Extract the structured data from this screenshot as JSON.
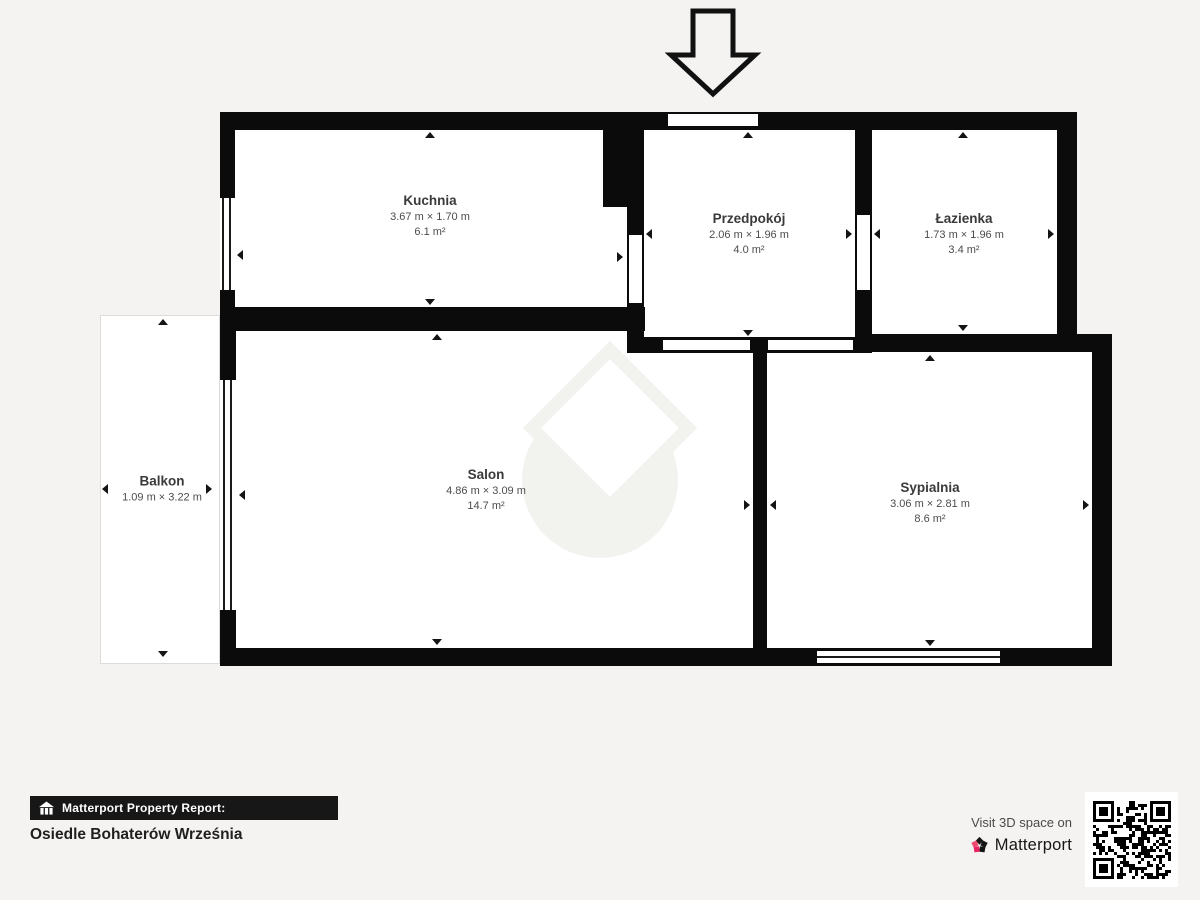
{
  "page": {
    "background": "#f4f3f1",
    "wall_color": "#0b0b0b"
  },
  "rooms": [
    {
      "name": "Kuchnia",
      "dimensions": "3.67 m × 1.70 m",
      "area": "6.1 m²"
    },
    {
      "name": "Przedpokój",
      "dimensions": "2.06 m × 1.96 m",
      "area": "4.0 m²"
    },
    {
      "name": "Łazienka",
      "dimensions": "1.73 m × 1.96 m",
      "area": "3.4 m²"
    },
    {
      "name": "Balkon",
      "dimensions": "1.09 m × 3.22 m",
      "area": ""
    },
    {
      "name": "Salon",
      "dimensions": "4.86 m × 3.09 m",
      "area": "14.7 m²"
    },
    {
      "name": "Sypialnia",
      "dimensions": "3.06 m × 2.81 m",
      "area": "8.6 m²"
    }
  ],
  "footer": {
    "report_label": "Matterport Property Report:",
    "property_name": "Osiedle Bohaterów Września",
    "visit_text": "Visit 3D space on",
    "brand_name": "Matterport",
    "brand_pink": "#e9235f",
    "brand_black": "#161616"
  },
  "icons": {
    "entrance_arrow": "down-arrow-outline",
    "report_icon": "house-with-pillars",
    "brand_icon": "matterport-pinwheel",
    "qr": "qr-code"
  }
}
